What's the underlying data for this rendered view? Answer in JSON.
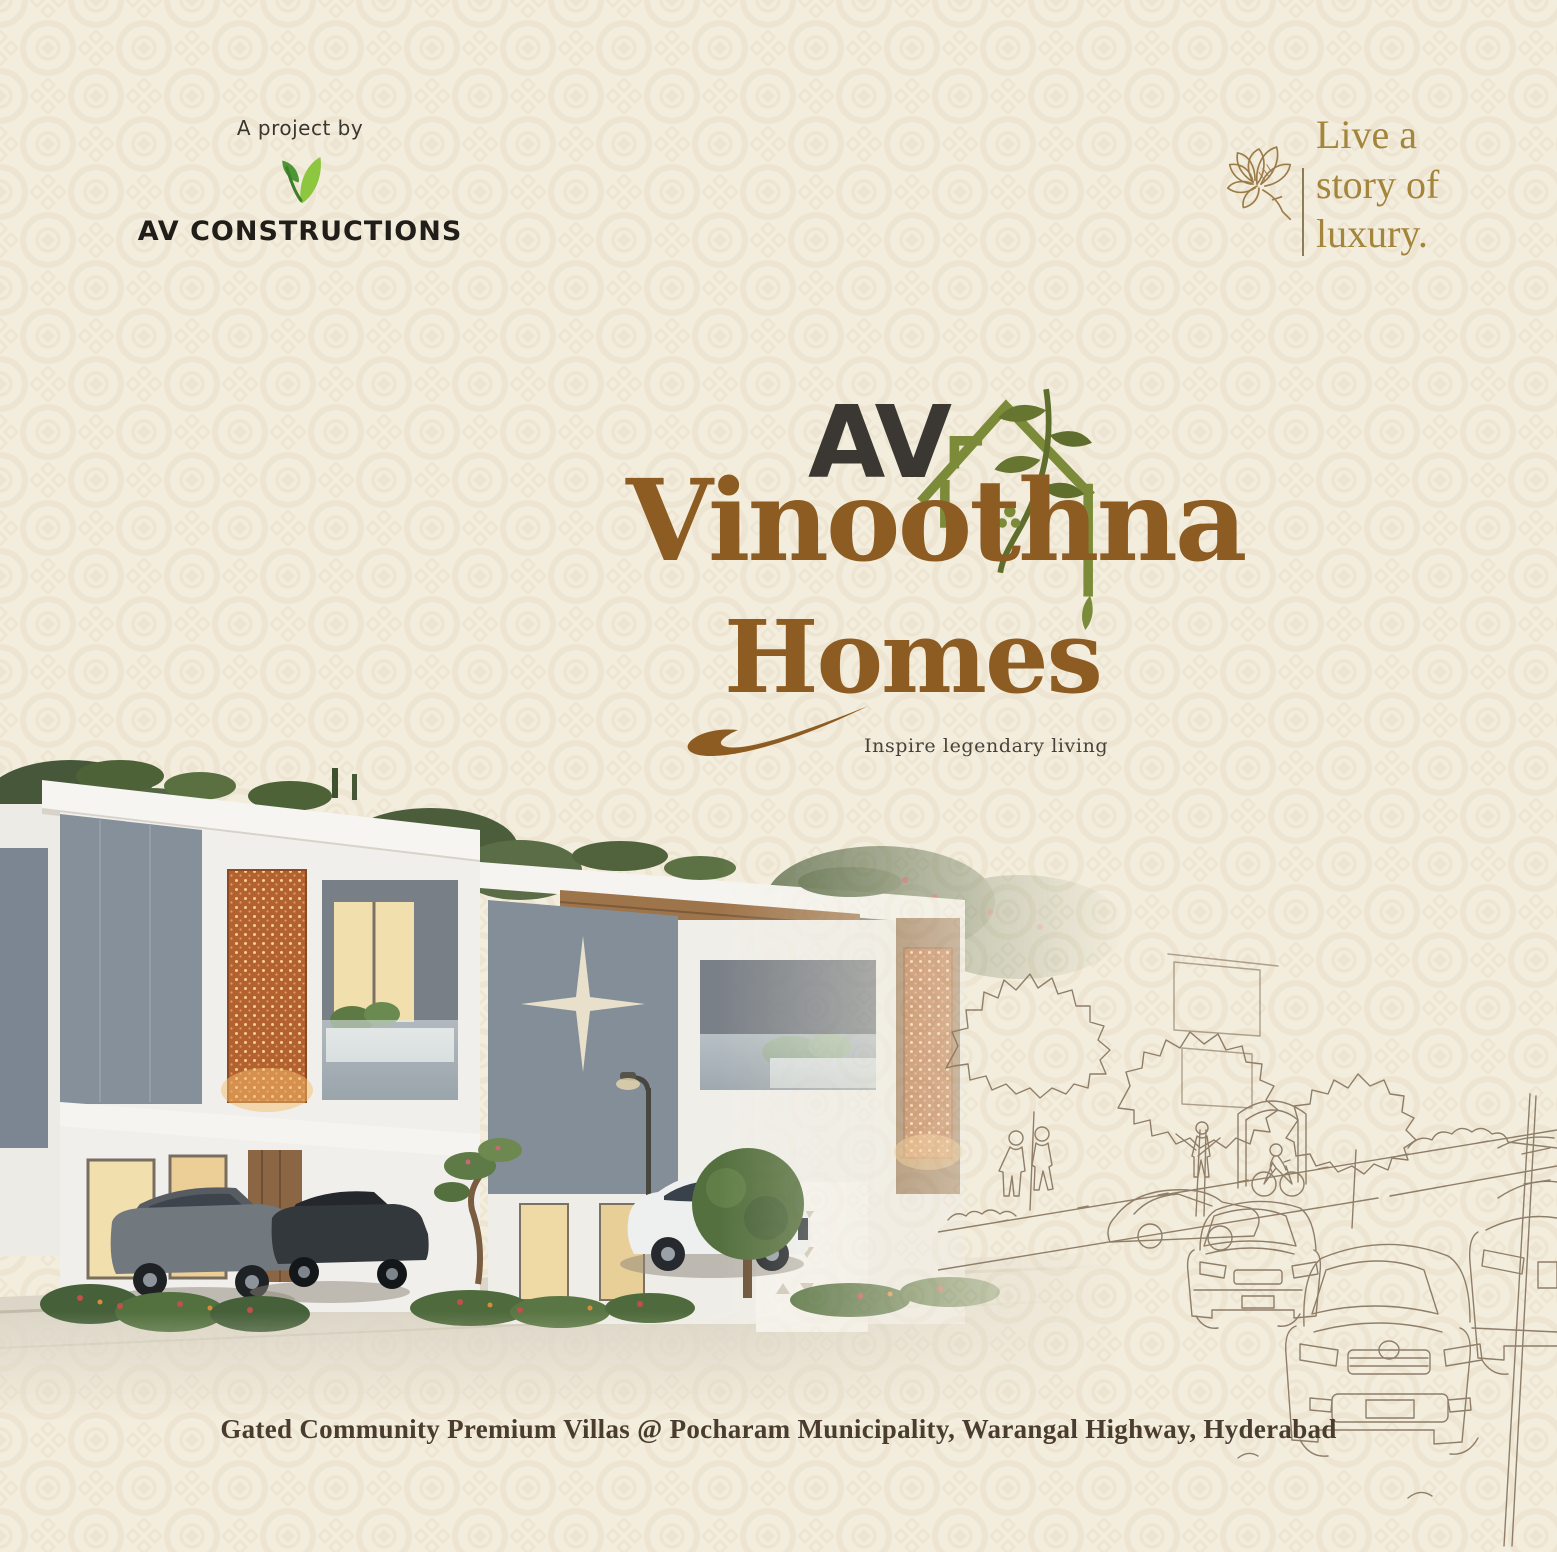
{
  "poster": {
    "background_color": "#f3eddd",
    "pattern_color": "#e8ddc5"
  },
  "developer": {
    "project_by_label": "A project by",
    "name": "AV CONSTRUCTIONS",
    "logo_icon": "av-leaf-monogram",
    "logo_green_light": "#8dc63f",
    "logo_green_dark": "#4c9734"
  },
  "tagline": {
    "icon": "flower-line-art",
    "lines": [
      "Live a",
      "story of",
      "luxury."
    ],
    "color": "#a3853c"
  },
  "logo": {
    "monogram": "AV",
    "monogram_color": "#3b3833",
    "house_icon": "house-with-leaf-branch",
    "house_green": "#7c8b3a",
    "name_line1": "Vinoothna",
    "name_line2": "Homes",
    "name_color": "#8d5c22",
    "subtitle": "Inspire legendary living",
    "subtitle_color": "#46423a"
  },
  "scene": {
    "rendering": "gated-community-villas-photo",
    "sketch": "street-line-art-sketch",
    "sketch_line_color": "#8a7963"
  },
  "footer": {
    "caption": "Gated Community Premium Villas @ Pocharam Municipality, Warangal Highway, Hyderabad",
    "caption_color": "#4a3d30"
  }
}
